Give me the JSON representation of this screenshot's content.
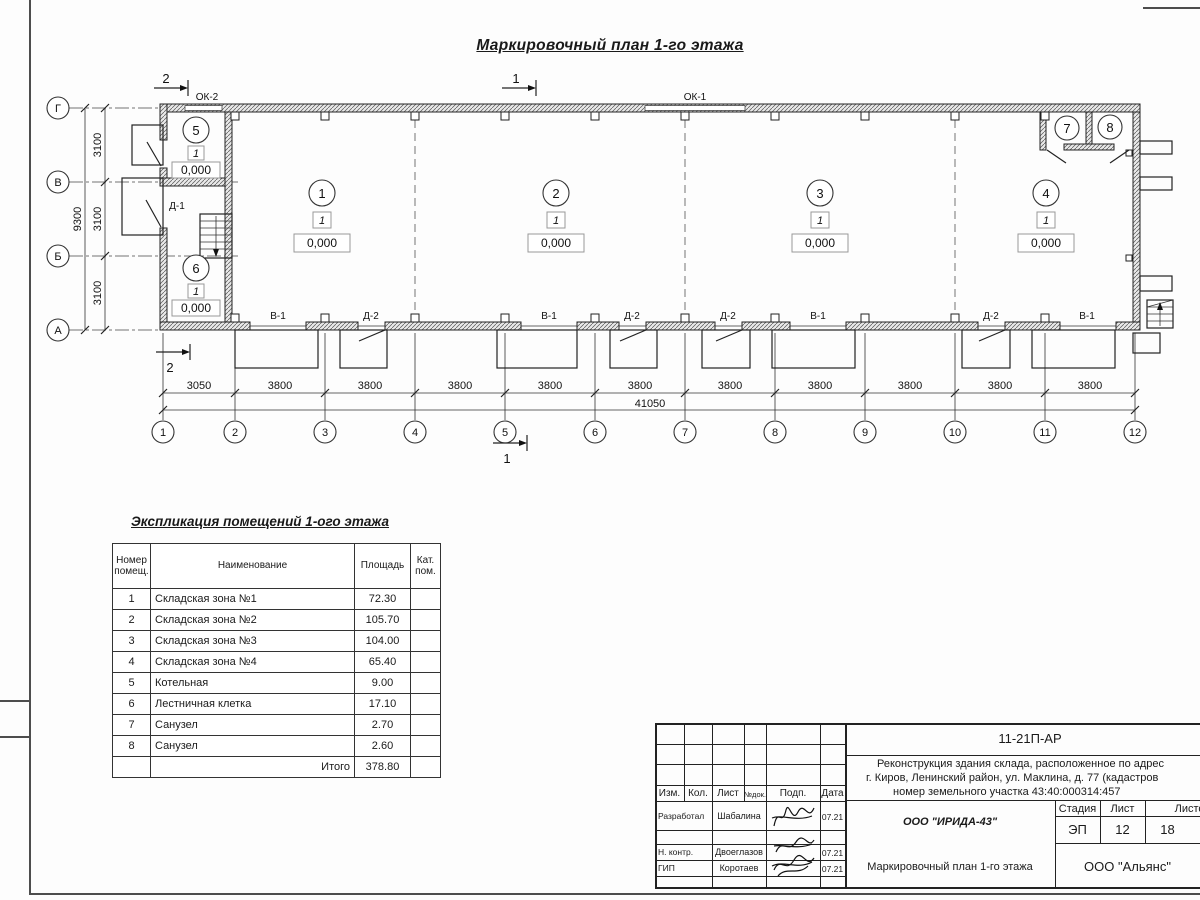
{
  "title": "Маркировочный план 1-го этажа",
  "plan": {
    "section_mark_1": "1",
    "section_mark_2": "2",
    "axis_letters": [
      "Г",
      "В",
      "Б",
      "А"
    ],
    "axis_numbers": [
      "1",
      "2",
      "3",
      "4",
      "5",
      "6",
      "7",
      "8",
      "9",
      "10",
      "11",
      "12"
    ],
    "vertical_dims": [
      "3100",
      "3100",
      "3100"
    ],
    "vertical_total": "9300",
    "bottom_dims": [
      "3050",
      "3800",
      "3800",
      "3800",
      "3800",
      "3800",
      "3800",
      "3800",
      "3800",
      "3800",
      "3800"
    ],
    "bottom_total": "41050",
    "window_labels": {
      "ok2": "ОК-2",
      "ok1": "ОК-1"
    },
    "door_labels": {
      "d1": "Д-1"
    },
    "opening_labels": [
      "В-1",
      "Д-2",
      "В-1",
      "Д-2",
      "Д-2",
      "В-1",
      "Д-2",
      "В-1"
    ],
    "rooms": [
      {
        "num": "1",
        "cat": "1",
        "elev": "0,000"
      },
      {
        "num": "2",
        "cat": "1",
        "elev": "0,000"
      },
      {
        "num": "3",
        "cat": "1",
        "elev": "0,000"
      },
      {
        "num": "4",
        "cat": "1",
        "elev": "0,000"
      },
      {
        "num": "5",
        "cat": "1",
        "elev": "0,000"
      },
      {
        "num": "6",
        "cat": "1",
        "elev": "0,000"
      },
      {
        "num": "7"
      },
      {
        "num": "8"
      }
    ]
  },
  "explication": {
    "title": "Экспликация помещений 1-ого этажа",
    "columns": [
      "Номер помещ.",
      "Наименование",
      "Площадь",
      "Кат. пом."
    ],
    "rows": [
      {
        "num": "1",
        "name": "Складская зона №1",
        "area": "72.30",
        "cat": ""
      },
      {
        "num": "2",
        "name": "Складская зона №2",
        "area": "105.70",
        "cat": ""
      },
      {
        "num": "3",
        "name": "Складская зона №3",
        "area": "104.00",
        "cat": ""
      },
      {
        "num": "4",
        "name": "Складская зона №4",
        "area": "65.40",
        "cat": ""
      },
      {
        "num": "5",
        "name": "Котельная",
        "area": "9.00",
        "cat": ""
      },
      {
        "num": "6",
        "name": "Лестничная клетка",
        "area": "17.10",
        "cat": ""
      },
      {
        "num": "7",
        "name": "Санузел",
        "area": "2.70",
        "cat": ""
      },
      {
        "num": "8",
        "name": "Санузел",
        "area": "2.60",
        "cat": ""
      }
    ],
    "total_label": "Итого",
    "total_area": "378.80"
  },
  "stamp": {
    "doc_code": "11-21П-АР",
    "project_line1": "Реконструкция здания склада, расположенное по адрес",
    "project_line2": "г. Киров, Ленинский район, ул. Маклина, д. 77 (кадастров",
    "project_line3": "номер земельного участка 43:40:000314:457",
    "col_headers": [
      "Изм.",
      "Кол.",
      "Лист",
      "№док.",
      "Подп.",
      "Дата"
    ],
    "roles": [
      {
        "role": "Разработал",
        "name": "Шабалина",
        "date": "07.21"
      },
      {
        "role": "Н. контр.",
        "name": "Двоеглазов",
        "date": "07.21"
      },
      {
        "role": "ГИП",
        "name": "Коротаев",
        "date": "07.21"
      }
    ],
    "org": "ООО \"ИРИДА-43\"",
    "sheet_name": "Маркировочный план 1-го этажа",
    "company": "ООО \"Альянс\"",
    "stage_label": "Стадия",
    "list_label": "Лист",
    "listov_label": "Листов",
    "stage": "ЭП",
    "list": "12",
    "listov": "18"
  }
}
